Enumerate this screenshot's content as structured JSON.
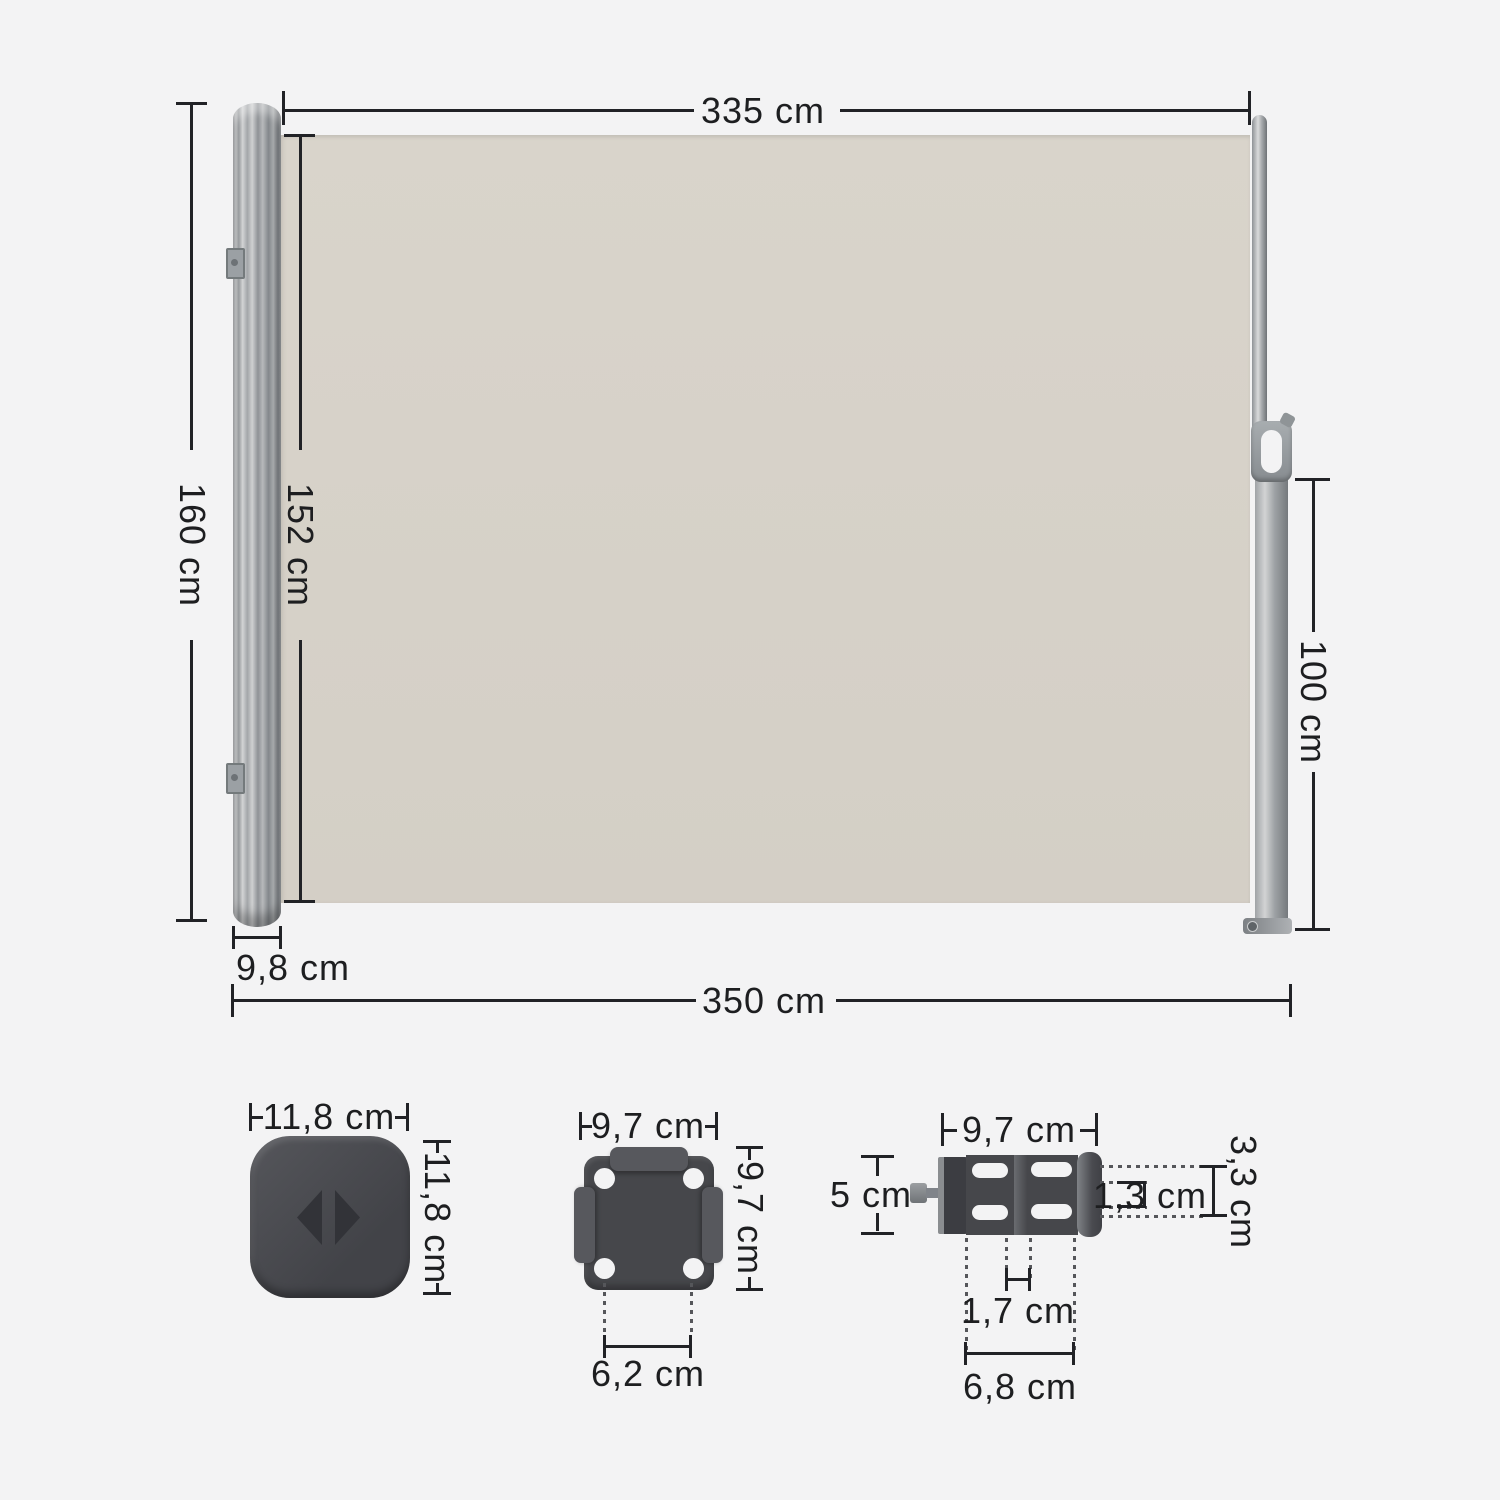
{
  "colors": {
    "background": "#f3f3f4",
    "fabric": "#d6d1c8",
    "hardware_dark": "#46474b",
    "dimension_line": "#212226"
  },
  "main": {
    "fabric_width": "335 cm",
    "total_height": "160 cm",
    "fabric_height": "152 cm",
    "pole_height": "100 cm",
    "cassette_depth": "9,8 cm",
    "total_width": "350 cm"
  },
  "parts": {
    "end_cap": {
      "width": "11,8 cm",
      "height": "11,8 cm"
    },
    "wall_plate": {
      "width": "9,7 cm",
      "height": "9,7 cm",
      "hole_spacing": "6,2 cm"
    },
    "pole_bracket": {
      "width": "9,7 cm",
      "height": "5 cm",
      "lip_depth": "1,3 cm",
      "side_height": "3,3 cm",
      "inner_gap": "1,7 cm",
      "outer_span": "6,8 cm"
    }
  }
}
